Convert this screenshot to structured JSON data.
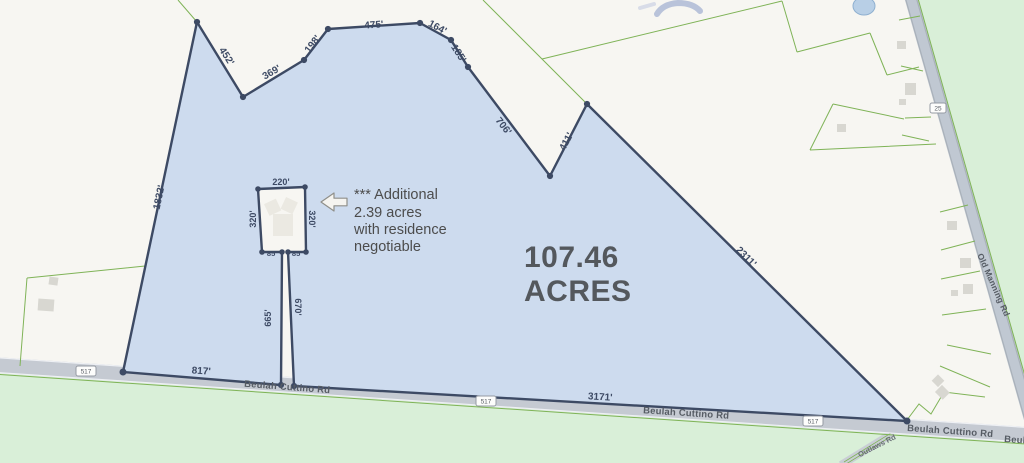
{
  "parcel": {
    "acres_line1": "107.46",
    "acres_line2": "ACRES",
    "dimensions": {
      "d452": "452'",
      "d369": "369'",
      "d198": "198'",
      "d475": "475'",
      "d164": "164'",
      "d185": "185'",
      "d706": "706'",
      "d411": "411'",
      "d2311": "2311'",
      "d1832": "1832'",
      "d817": "817'",
      "d3171": "3171'"
    }
  },
  "excluded_parcel": {
    "dimensions": {
      "top": "220'",
      "left": "320'",
      "right": "320'",
      "bottom_left": "85'",
      "bottom_right": "85'"
    },
    "lane": {
      "left": "665'",
      "right": "670'"
    }
  },
  "annotation": {
    "line1": "*** Additional",
    "line2": "2.39 acres",
    "line3": "with residence",
    "line4": "negotiable"
  },
  "roads": {
    "beulah_cuttino": "Beulah Cuttino Rd",
    "old_manning": "Old Manning Rd",
    "outlaws": "Outlaws Rd",
    "route_517": "517",
    "route_25": "25"
  },
  "colors": {
    "parcel_fill": "#cddbee",
    "boundary": "#3d4a64",
    "road_fill": "#c5cad2",
    "green_area": "#d9efd8",
    "green_line": "#7fb357",
    "dimension_label": "#3d4a64",
    "acreage_text": "#54585d"
  }
}
